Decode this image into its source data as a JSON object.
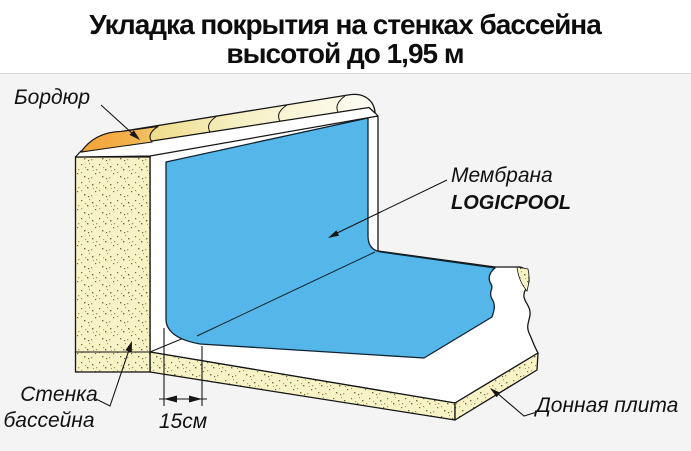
{
  "title": {
    "line1": "Укладка покрытия на стенках бассейна",
    "line2": "высотой до 1,95 м"
  },
  "labels": {
    "curb": "Бордюр",
    "membrane_line1": "Мембрана",
    "membrane_line2": "LOGICPOOL",
    "wall_line1": "Стенка",
    "wall_line2": "бассейна",
    "dimension": "15см",
    "bottom_slab": "Донная плита"
  },
  "colors": {
    "membrane_blue": "#55b7e9",
    "wall_beige": "#f8f3c6",
    "curb_orange": "#f5a339",
    "slab_white": "#ffffff",
    "diagram_background": "#f4f4f5",
    "line": "#161616"
  }
}
